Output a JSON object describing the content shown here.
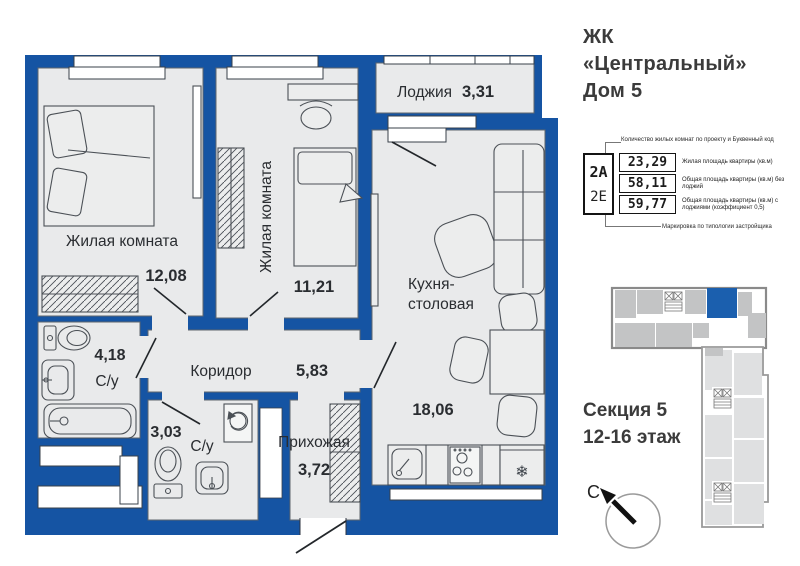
{
  "header": {
    "title_line1": "ЖК",
    "title_line2": "«Центральный»",
    "title_line3": "Дом 5"
  },
  "floor_plan": {
    "rooms": [
      {
        "name": "Лоджия",
        "area": "3,31"
      },
      {
        "name": "Жилая комната",
        "area": "12,08"
      },
      {
        "name": "Жилая комната",
        "area": "11,21"
      },
      {
        "name": "Кухня-столовая",
        "name_lines": [
          "Кухня-",
          "столовая"
        ],
        "area": "18,06"
      },
      {
        "name": "Коридор",
        "area": "5,83"
      },
      {
        "name": "С/у",
        "area": "4,18"
      },
      {
        "name": "С/у",
        "area": "3,03"
      },
      {
        "name": "Прихожая",
        "area": "3,72"
      }
    ]
  },
  "spec_card": {
    "annotation_top": "Количество жилых комнат по проекту и Буквенный код",
    "code_primary": "2А",
    "code_secondary": "2Е",
    "rows": [
      {
        "value": "23,29",
        "label": "Жилая площадь квартиры (кв.м)"
      },
      {
        "value": "58,11",
        "label": "Общая площадь квартиры (кв.м) без лоджий"
      },
      {
        "value": "59,77",
        "label": "Общая площадь квартиры (кв.м) с лоджиями (коэффициент 0,5)"
      }
    ],
    "annotation_bottom": "Маркировка по типологии застройщика"
  },
  "section_info": {
    "line1": "Секция 5",
    "line2": "12-16 этаж"
  },
  "compass": {
    "north_label": "С"
  },
  "colors": {
    "wall": "#1554a3",
    "room_fill": "#e9eaeb",
    "highlight_unit": "#1b5fae",
    "map_unit": "#c3c4c5",
    "map_unit_light": "#dfe0e1"
  }
}
